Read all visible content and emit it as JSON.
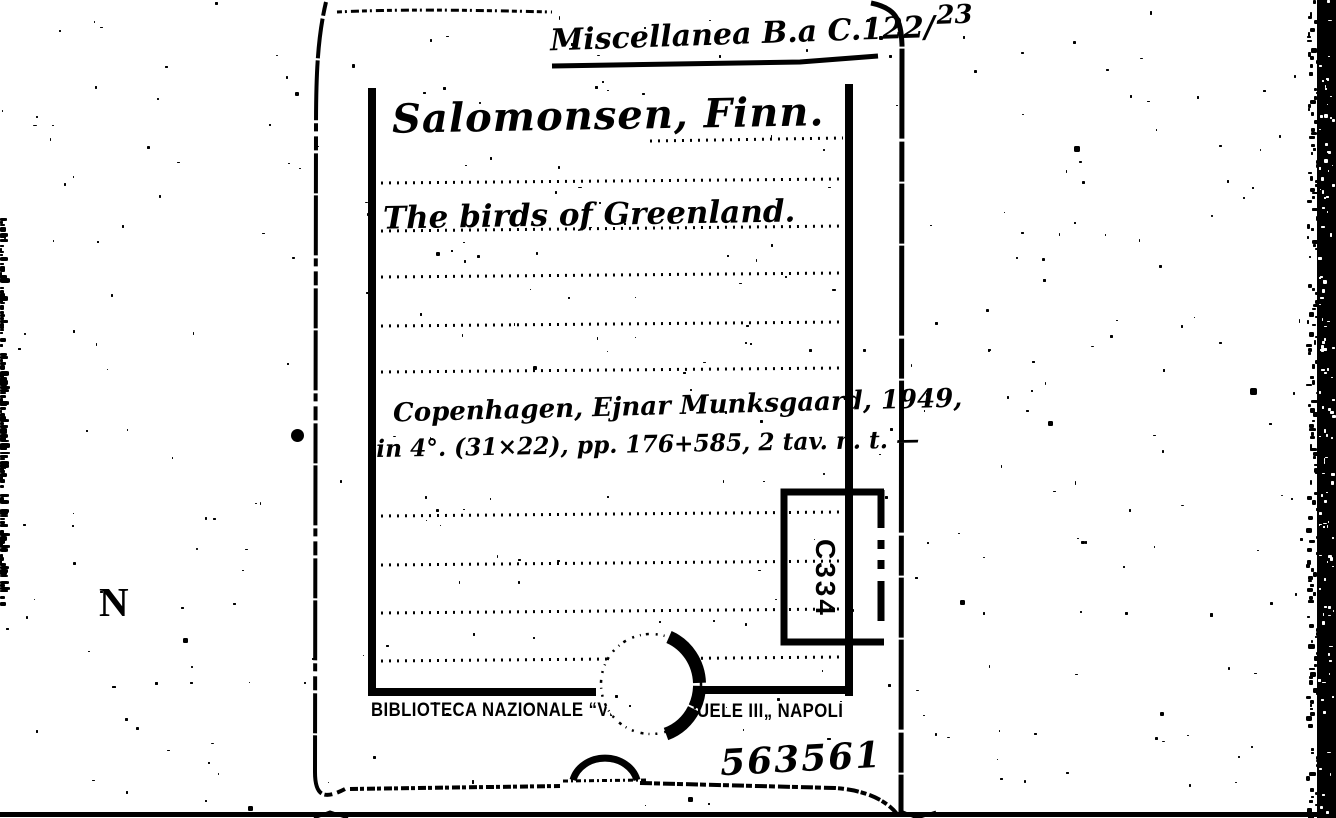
{
  "card": {
    "call_number": {
      "collection": "Miscellanea B.a C.122/",
      "item": "23"
    },
    "author": "Salomonsen, Finn.",
    "title": "The birds of Greenland.",
    "imprint": {
      "line1": "Copenhagen, Ejnar Munksgaard, 1949,",
      "line2": "in 4°. (31×22), pp. 176+585, 2 tav. n. t. —"
    },
    "shelf_stamp_code": "C334",
    "library_stamp": {
      "left_fragment": "BIBLIOTECA NAZIONALE “VITT",
      "right_fragment": "UELE III„ NAPOLI"
    },
    "accession_number": "563561"
  },
  "margin_letter": "N",
  "colors": {
    "ink": "#000000",
    "paper": "#ffffff"
  }
}
